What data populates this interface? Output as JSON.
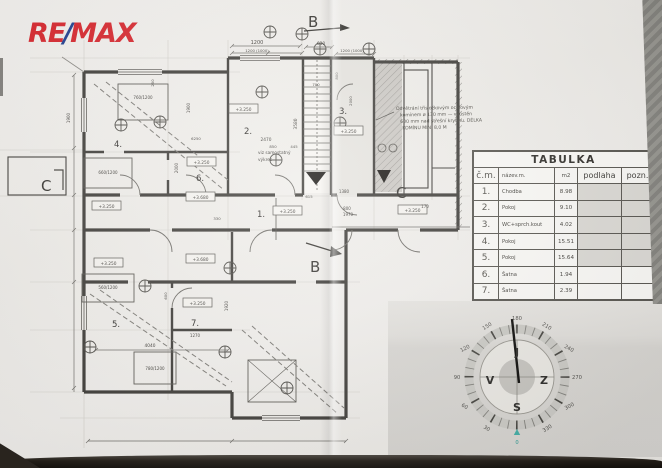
{
  "logo": {
    "re": "RE",
    "slash": "/",
    "max": "MAX"
  },
  "table": {
    "title": "TABULKA",
    "headers": [
      "č.m.",
      "název.m.",
      "m2",
      "podlaha",
      "pozn."
    ],
    "rows": [
      {
        "num": "1.",
        "name": "Chodba",
        "area": "8.98"
      },
      {
        "num": "2.",
        "name": "Pokoj",
        "area": "9.10"
      },
      {
        "num": "3.",
        "name": "WC+sprch.kout",
        "area": "4.02"
      },
      {
        "num": "4.",
        "name": "Pokoj",
        "area": "15.51"
      },
      {
        "num": "5.",
        "name": "Pokoj",
        "area": "15.64"
      },
      {
        "num": "6.",
        "name": "Šatna",
        "area": "1.94"
      },
      {
        "num": "7.",
        "name": "Šatna",
        "area": "2.39"
      }
    ]
  },
  "plan": {
    "rooms": [
      "1.",
      "2.",
      "3.",
      "4.",
      "5.",
      "6.",
      "7."
    ],
    "elevations": [
      "+3.250",
      "+3.250",
      "+3.250",
      "+3.250",
      "+3.250",
      "+3.250",
      "+3.250",
      "+3.250",
      "+3.680",
      "+3.680"
    ],
    "windows": [
      "760/1200",
      "660/1200",
      "560/1200",
      "780/1200"
    ],
    "sections": {
      "b": "B",
      "c": "C"
    },
    "note": [
      "Odvětrání třísložkovým ocelovým",
      "komínem ø 130 mm — vyústěn",
      "600 mm nad střešní krytinu. DÉLKA",
      "KOMÍNU MIN. 8,0 M"
    ],
    "ref_note": [
      "viz samostatný",
      "výkres"
    ],
    "dims": [
      "1200",
      "1200 (1000)",
      "630",
      "1200 (1000)",
      "2470",
      "3580",
      "850",
      "445",
      "615",
      "1380",
      "800",
      "1970",
      "6250",
      "1900",
      "250",
      "2000",
      "800",
      "2000",
      "4040",
      "1920",
      "1270",
      "600",
      "1900",
      "170",
      "330",
      "700"
    ]
  },
  "compass": {
    "letters": {
      "top": "J",
      "right": "Z",
      "bottom": "S",
      "left": "V"
    },
    "degrees": [
      "180",
      "210",
      "240",
      "270",
      "300",
      "330",
      "30",
      "60",
      "90",
      "120",
      "150"
    ],
    "zero": "0"
  }
}
